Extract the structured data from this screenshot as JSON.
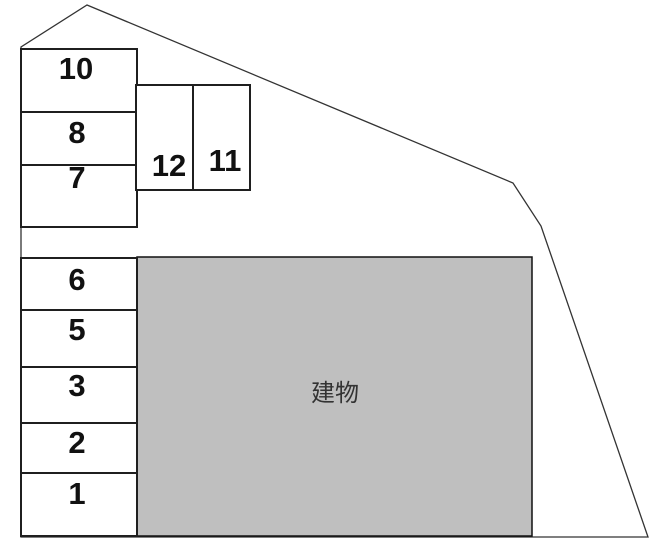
{
  "diagram": {
    "building": {
      "label": "建物",
      "fill_color": "#bfbfbf"
    },
    "spaces": [
      {
        "label": "10"
      },
      {
        "label": "8"
      },
      {
        "label": "7"
      },
      {
        "label": "12"
      },
      {
        "label": "11"
      },
      {
        "label": "6"
      },
      {
        "label": "5"
      },
      {
        "label": "3"
      },
      {
        "label": "2"
      },
      {
        "label": "1"
      }
    ],
    "colors": {
      "boundary_line": "#333333",
      "space_border": "#1f1f1f",
      "space_fill": "#ffffff",
      "label_color": "#111111",
      "building_label_color": "#333333"
    }
  }
}
